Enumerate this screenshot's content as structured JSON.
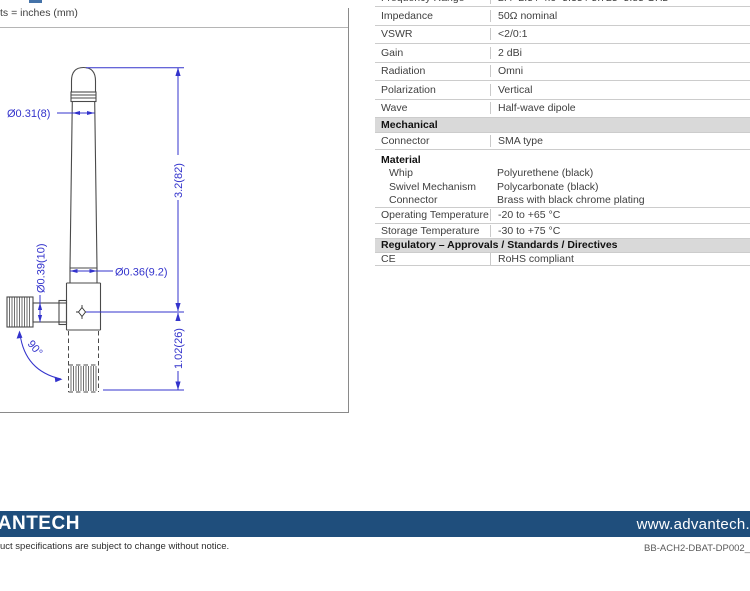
{
  "drawing": {
    "units_note": "ts = inches (mm)",
    "labels": {
      "dia_whip": "Ø0.31(8)",
      "dia_base": "Ø0.36(9.2)",
      "dia_swivel": "Ø0.39(10)",
      "len_whip": "3.2(82)",
      "len_conn": "1.02(26)",
      "angle": "90°"
    }
  },
  "table": {
    "rows": [
      {
        "label": "Frequency Range",
        "value": "2.4–2.5 / 4.9–5.35 / 5.725–5.85 GHz"
      },
      {
        "label": "Impedance",
        "value": "50Ω nominal"
      },
      {
        "label": "VSWR",
        "value": "<2/0:1"
      },
      {
        "label": "Gain",
        "value": "2 dBi"
      },
      {
        "label": "Radiation",
        "value": "Omni"
      },
      {
        "label": "Polarization",
        "value": "Vertical"
      },
      {
        "label": "Wave",
        "value": "Half-wave dipole"
      }
    ],
    "section_mechanical": "Mechanical",
    "connector_row": {
      "label": "Connector",
      "value": "SMA type"
    },
    "material": {
      "title": "Material",
      "items": [
        {
          "label": "Whip",
          "value": "Polyurethene (black)"
        },
        {
          "label": "Swivel Mechanism",
          "value": "Polycarbonate (black)"
        },
        {
          "label": "Connector",
          "value": "Brass with black chrome plating"
        }
      ]
    },
    "temp_rows": [
      {
        "label": "Operating Temperature",
        "value": "-20 to +65 °C"
      },
      {
        "label": "Storage Temperature",
        "value": "-30 to +75 °C"
      }
    ],
    "section_regulatory": "Regulatory – Approvals / Standards / Directives",
    "ce_row": {
      "label": "CE",
      "value": "RoHS compliant"
    }
  },
  "footer": {
    "logo_text": "VANTECH",
    "tagline": "uct specifications are subject to change without notice.",
    "website": "www.advantech.",
    "doc_number": "BB-ACH2-DBAT-DP002_"
  }
}
